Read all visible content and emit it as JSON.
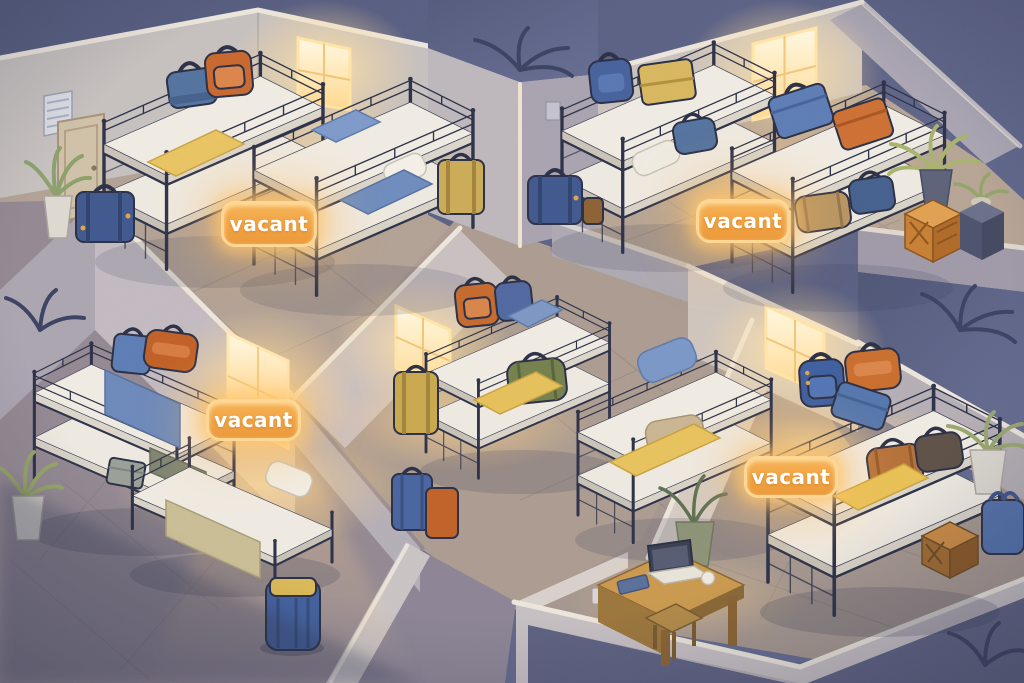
{
  "scene": {
    "setting": "Isometric cutaway illustration of a hostel dormitory at night with five rooms, metal bunk beds, luggage and warm glowing windows",
    "style": "flat illustration, dusk blue exterior, warm amber interior light",
    "vacancy_labels": [
      {
        "text": "vacant",
        "room": "top-left dorm"
      },
      {
        "text": "vacant",
        "room": "top-right dorm"
      },
      {
        "text": "vacant",
        "room": "middle-left dorm"
      },
      {
        "text": "vacant",
        "room": "bottom-right dorm"
      }
    ],
    "rooms": [
      {
        "name": "top-left dorm",
        "beds": "2 bunk beds",
        "status": "vacant",
        "items": [
          "blue duffel bag",
          "orange backpack",
          "yellow blanket",
          "blue blankets",
          "white pillow",
          "air vent",
          "door",
          "glowing window",
          "potted plant",
          "blue suitcase",
          "tan suitcase"
        ]
      },
      {
        "name": "top-right dorm",
        "beds": "2 bunk beds",
        "status": "vacant",
        "items": [
          "blue backpack",
          "tan suitcase",
          "blue suitcase",
          "orange suitcase",
          "tan duffel",
          "blue duffels",
          "brown bag",
          "glowing window",
          "palm plant",
          "orange crate",
          "plant stand"
        ]
      },
      {
        "name": "center dorm",
        "beds": "2 bunk beds",
        "status": "occupied",
        "items": [
          "orange backpack",
          "blue backpack",
          "green duffel",
          "yellow blankets",
          "blue pillow",
          "tan cushions",
          "tan suitcase",
          "glowing window"
        ]
      },
      {
        "name": "middle-left dorm",
        "beds": "1 bunk bed and 1 single bed",
        "status": "vacant",
        "items": [
          "blue suitcase",
          "orange duffel",
          "blue blanket",
          "gray box",
          "gray-green blanket",
          "khaki blanket",
          "white pillow",
          "potted plant",
          "glowing window"
        ]
      },
      {
        "name": "bottom-right dorm",
        "beds": "1 bunk bed",
        "status": "vacant",
        "items": [
          "blue backpack",
          "orange bag",
          "blue suitcase",
          "brown duffel",
          "dark duffel",
          "yellow blanket",
          "desk with laptop",
          "notebook",
          "stool",
          "potted plants",
          "wooden crate",
          "blue tote bag",
          "glowing window"
        ]
      }
    ],
    "hallway_items": [
      "blue duffel with yellow strap",
      "blue suitcase",
      "orange suitcase"
    ],
    "palette": {
      "exterior_night": "#5b6183",
      "wall_light": "#cfc7c2",
      "wall_shadow": "#a9a4b0",
      "floor_warm": "#b3a294",
      "floor_cool": "#8d8595",
      "bed_frame": "#2d3249",
      "mattress": "#efeae1",
      "window_glow": "#ffe9b5",
      "badge_fill": "#f0a544",
      "badge_border": "#ffd794",
      "badge_text": "#ffffff",
      "accent_blue": "#54739f",
      "accent_orange": "#c8682f",
      "accent_yellow": "#e8c463"
    }
  }
}
